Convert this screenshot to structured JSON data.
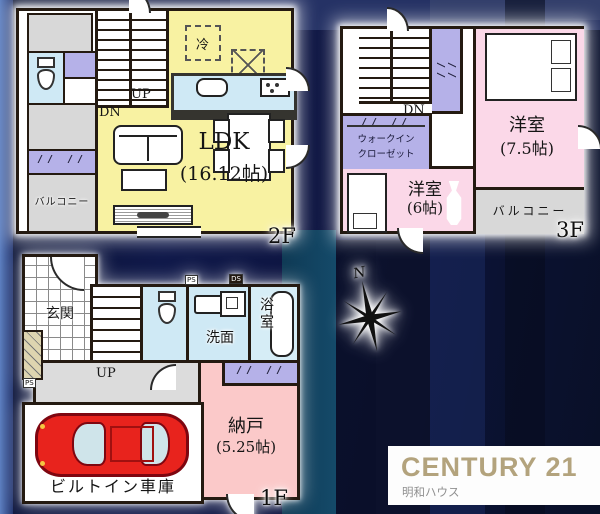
{
  "colors": {
    "background": "#0e1638",
    "wall": "#241a11",
    "ldk_yellow": "#f8f2a2",
    "room_pink": "#fbd8e8",
    "storage_pink": "#fbc9c9",
    "closet_lavender": "#b5b1e8",
    "water_blue": "#cfe9f5",
    "balcony_gray": "#d8d8d8",
    "car_red": "#e8231d",
    "brand_gold": "#b3a37d"
  },
  "f2": {
    "label": "2F",
    "ldk_name": "LDK",
    "ldk_size": "(16.12帖)",
    "balcony": "バルコニー",
    "up": "UP",
    "dn": "DN",
    "fridge": "冷",
    "window_marks": "// //"
  },
  "f3": {
    "label": "3F",
    "room1_name": "洋室",
    "room1_size": "(7.5帖)",
    "room2_name": "洋室",
    "room2_size": "(6帖)",
    "wic_line1": "ウォークイン",
    "wic_line2": "クローゼット",
    "balcony": "バルコニー",
    "dn": "DN",
    "window_marks": "// //"
  },
  "f1": {
    "label": "1F",
    "genkan": "玄関",
    "washroom": "洗面",
    "bathroom": "浴室",
    "nando_name": "納戸",
    "nando_size": "(5.25帖)",
    "garage": "ビルトイン車庫",
    "up": "UP",
    "ps1": "PS",
    "ps2": "PS",
    "ds": "DS",
    "window_marks": "// //"
  },
  "compass": {
    "north": "N"
  },
  "logo": {
    "brand": "CENTURY 21",
    "company": "明和ハウス"
  }
}
